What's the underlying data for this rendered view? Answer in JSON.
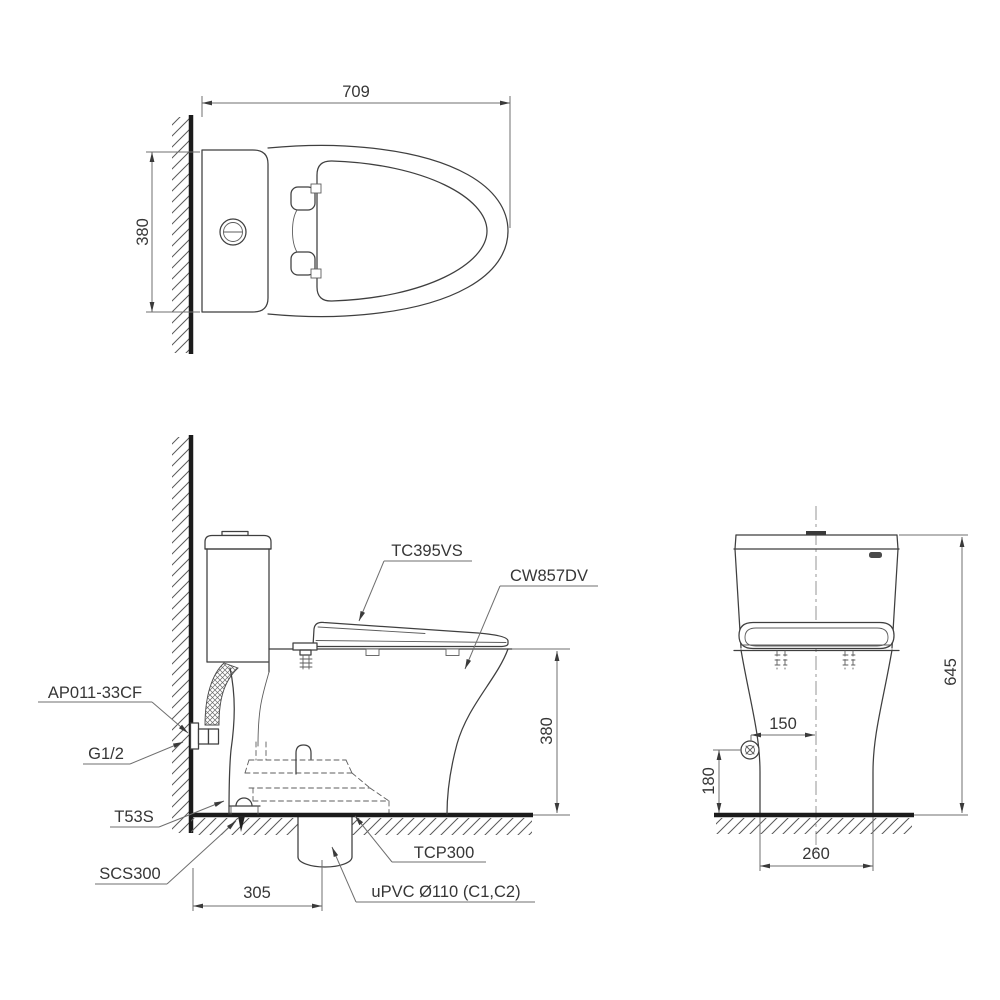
{
  "drawing": {
    "top_view": {
      "width_mm": "709",
      "depth_mm": "380"
    },
    "side_view": {
      "seat_model": "TC395VS",
      "bowl_model": "CW857DV",
      "supply_hose": "AP011-33CF",
      "supply_thread": "G1/2",
      "fixing_bolt": "T53S",
      "floor_flange": "SCS300",
      "trap_adapter": "TCP300",
      "drain_pipe": "uPVC Ø110 (C1,C2)",
      "seat_height_mm": "380",
      "outlet_from_wall_mm": "305"
    },
    "front_view": {
      "total_height_mm": "645",
      "supply_offset_mm": "150",
      "supply_height_mm": "180",
      "base_width_mm": "260"
    }
  }
}
